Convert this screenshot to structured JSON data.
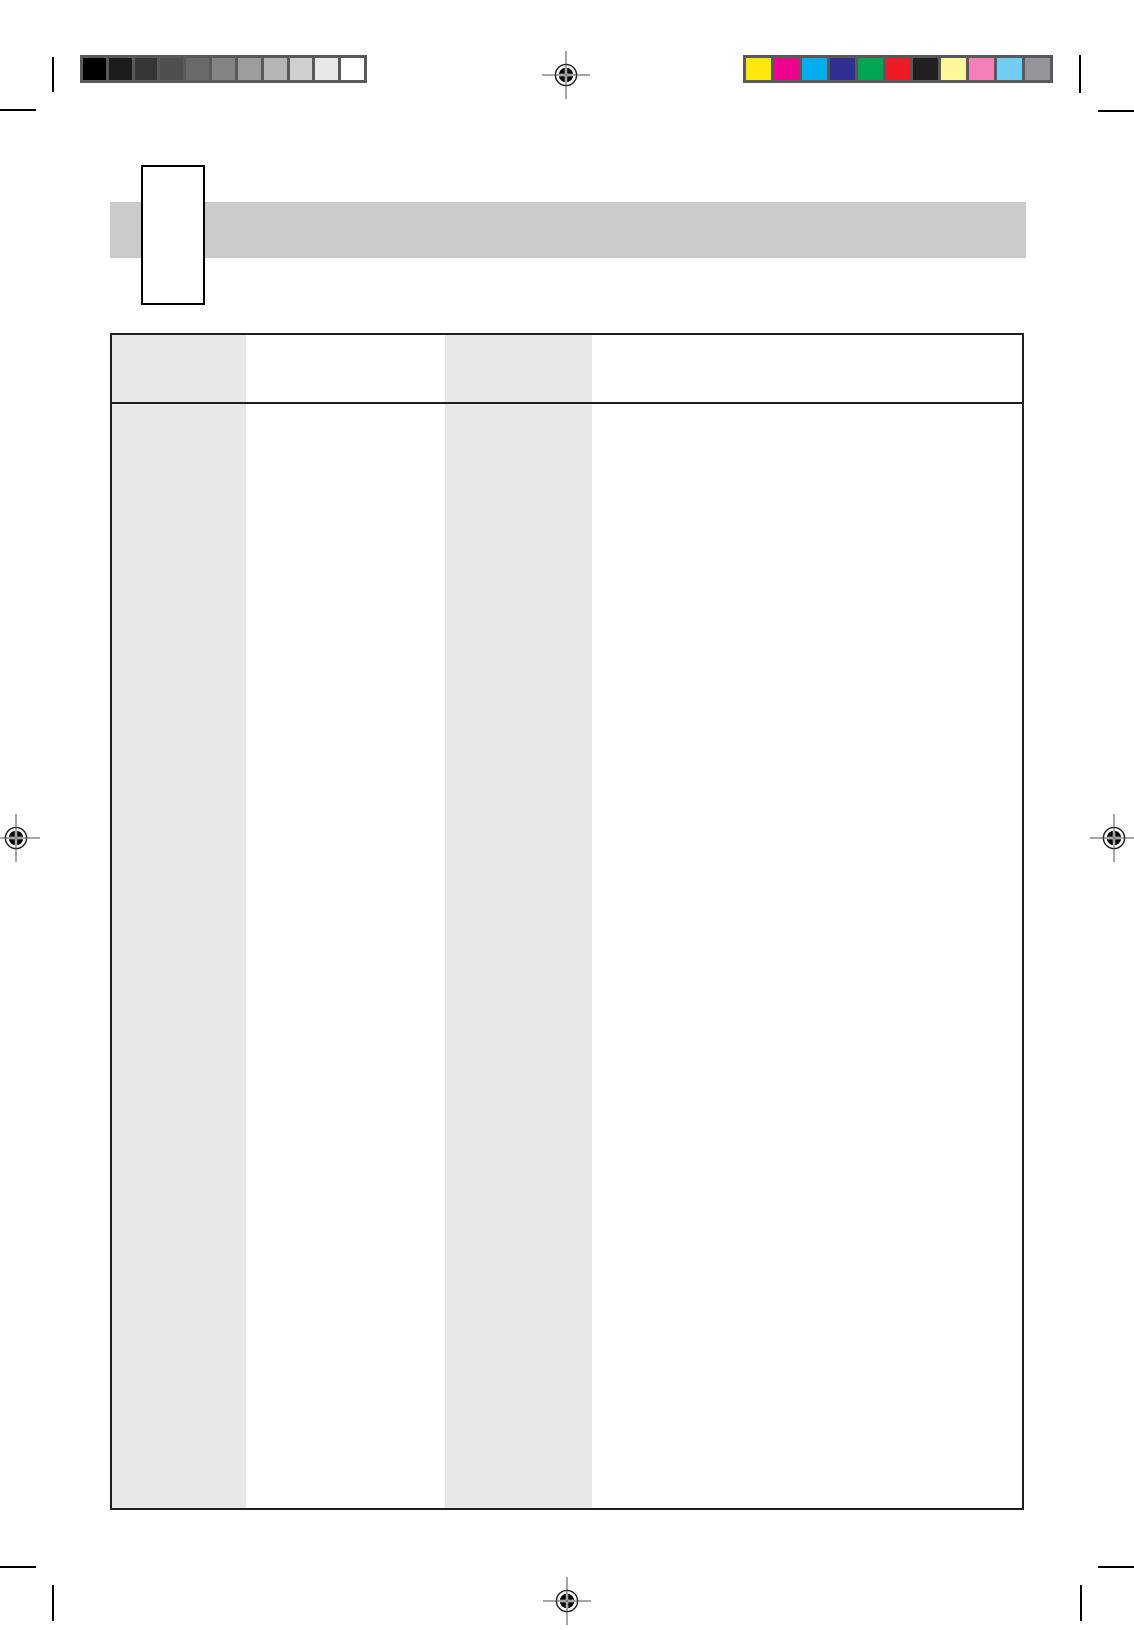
{
  "page": {
    "background_color": "#ffffff"
  },
  "print_marks": {
    "grayscale_bar": {
      "frame_color": "#58595b",
      "swatches": [
        "#000000",
        "#1c1c1c",
        "#363636",
        "#4f4f4f",
        "#696969",
        "#838383",
        "#9c9c9c",
        "#b5b5b5",
        "#cfcfcf",
        "#e8e8e8",
        "#ffffff"
      ]
    },
    "color_bar": {
      "frame_color": "#58595b",
      "swatches": [
        "#fce80d",
        "#ec008c",
        "#00aeef",
        "#2e3192",
        "#00a651",
        "#ed1c24",
        "#231f20",
        "#fff799",
        "#f47fb8",
        "#72cdf4",
        "#949599"
      ]
    },
    "registration_mark": {
      "ring_color": "#1a1a1a",
      "fill_color": "#000000",
      "line_color": "#4d4d4d",
      "gap_color": "#ffffff"
    },
    "registration_mark_positions": [
      "top-center",
      "middle-left",
      "middle-right",
      "bottom-center"
    ],
    "crop_mark_color": "#000000"
  },
  "header": {
    "banner_color": "#cbcbcb",
    "tab_box_fill": "#ffffff",
    "tab_box_border": "#000000"
  },
  "table": {
    "border_color": "#1f1f1f",
    "shaded_fill": "#e8e8e8",
    "column_count": 4,
    "columns": [
      {
        "shaded": true
      },
      {
        "shaded": false
      },
      {
        "shaded": true
      },
      {
        "shaded": false
      }
    ],
    "visible_rows": 2,
    "header_text": "",
    "body_text": ""
  }
}
